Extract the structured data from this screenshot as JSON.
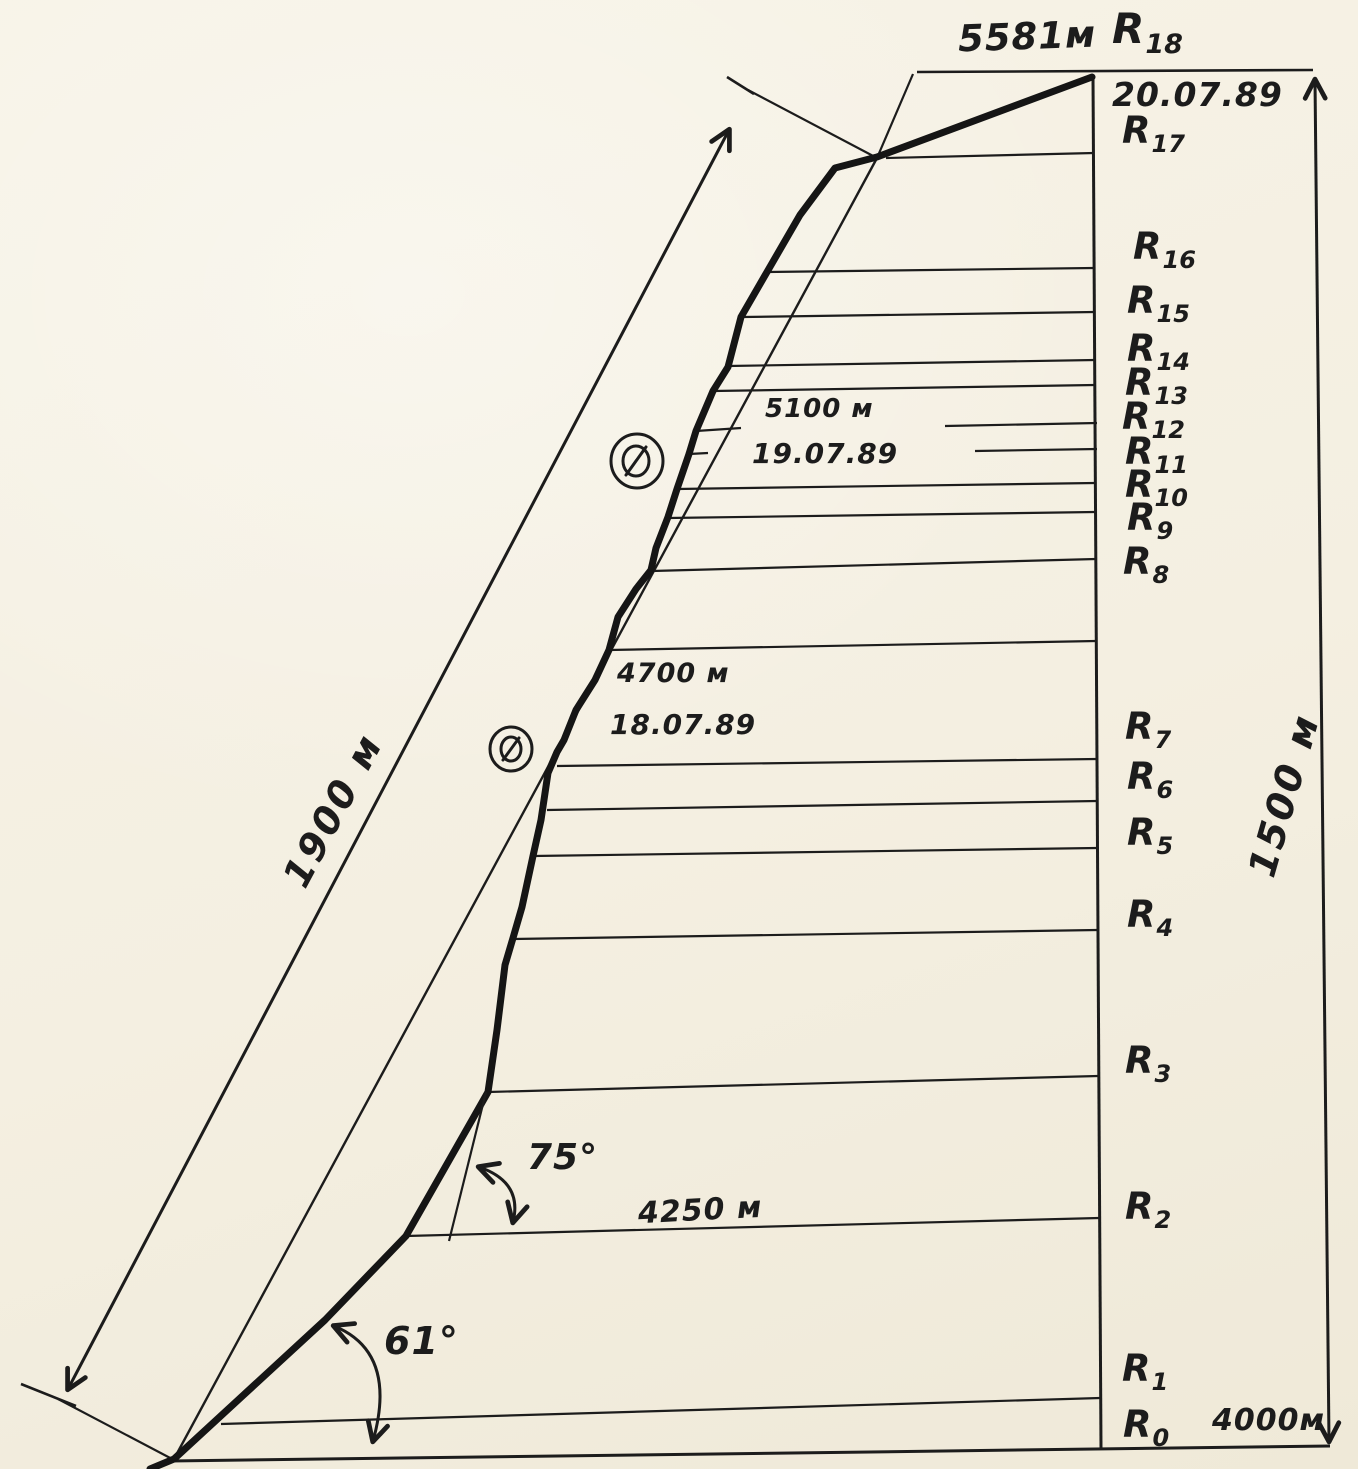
{
  "diagram": {
    "kind": "hand-drawn mountaineering route profile",
    "summit": {
      "altitude": "5581м",
      "date": "20.07.89"
    },
    "camps": [
      {
        "altitude": "5100 м",
        "date": "19.07.89"
      },
      {
        "altitude": "4700 м",
        "date": "18.07.89"
      }
    ],
    "mid_altitude": "4250 м",
    "base_altitude": "4000м",
    "dimensions": {
      "route_length": "1900 м",
      "wall_height": "1500 м"
    },
    "angles": {
      "lower_slope": "61°",
      "upper_slope": "75°"
    },
    "ink_color": "#1c1c1c",
    "paper_color": "#f4efe1",
    "icons": [
      {
        "name": "bivouac-circle-icon",
        "meaning": "circled slashed-zero camp mark (upper)"
      },
      {
        "name": "bivouac-circle-icon",
        "meaning": "circled slashed-zero camp mark (lower)"
      }
    ]
  },
  "stations": [
    {
      "base": "R",
      "sub": "0"
    },
    {
      "base": "R",
      "sub": "1"
    },
    {
      "base": "R",
      "sub": "2"
    },
    {
      "base": "R",
      "sub": "3"
    },
    {
      "base": "R",
      "sub": "4"
    },
    {
      "base": "R",
      "sub": "5"
    },
    {
      "base": "R",
      "sub": "6"
    },
    {
      "base": "R",
      "sub": "7"
    },
    {
      "base": "R",
      "sub": "8"
    },
    {
      "base": "R",
      "sub": "9"
    },
    {
      "base": "R",
      "sub": "10"
    },
    {
      "base": "R",
      "sub": "11"
    },
    {
      "base": "R",
      "sub": "12"
    },
    {
      "base": "R",
      "sub": "13"
    },
    {
      "base": "R",
      "sub": "14"
    },
    {
      "base": "R",
      "sub": "15"
    },
    {
      "base": "R",
      "sub": "16"
    },
    {
      "base": "R",
      "sub": "17"
    },
    {
      "base": "R",
      "sub": "18"
    }
  ]
}
